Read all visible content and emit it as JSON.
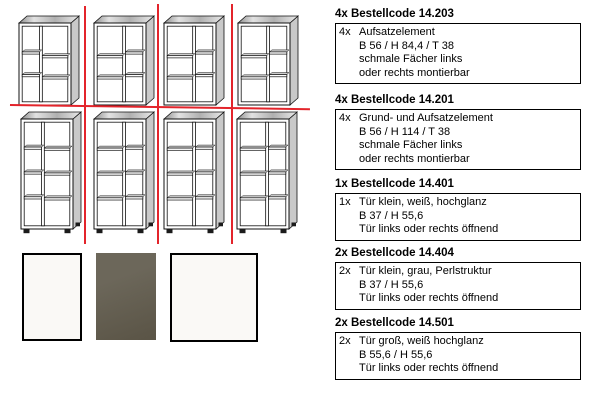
{
  "page": {
    "background": "#ffffff",
    "guide_color": "#e3242b"
  },
  "drawings": {
    "description": "shelf-unit-line-drawings",
    "units": [
      {
        "name": "shelf-aufsatz-1",
        "row": "top",
        "narrow": "left"
      },
      {
        "name": "shelf-aufsatz-2",
        "row": "top",
        "narrow": "right"
      },
      {
        "name": "shelf-aufsatz-3",
        "row": "top",
        "narrow": "right"
      },
      {
        "name": "shelf-aufsatz-4",
        "row": "top",
        "narrow": "right"
      },
      {
        "name": "shelf-grund-1",
        "row": "bottom",
        "narrow": "left"
      },
      {
        "name": "shelf-grund-2",
        "row": "bottom",
        "narrow": "right"
      },
      {
        "name": "shelf-grund-3",
        "row": "bottom",
        "narrow": "right"
      },
      {
        "name": "shelf-grund-4",
        "row": "bottom",
        "narrow": "right"
      }
    ]
  },
  "swatches": [
    {
      "name": "swatch-white-gloss-small",
      "color": "#faf9f6",
      "border": true
    },
    {
      "name": "swatch-grey-pearl",
      "color": "#6c675a",
      "color2": "#5b5547",
      "border": false
    },
    {
      "name": "swatch-white-gloss-large",
      "color": "#faf9f6",
      "border": true
    }
  ],
  "sections": [
    {
      "heading": "4x Bestellcode 14.203",
      "qty": "4x",
      "lines": [
        "Aufsatzelement",
        "B 56 / H 84,4 / T 38",
        "schmale Fächer links",
        "oder rechts montierbar"
      ]
    },
    {
      "heading": "4x Bestellcode 14.201",
      "qty": "4x",
      "lines": [
        "Grund- und Aufsatzelement",
        "B 56 / H 114 / T 38",
        "schmale Fächer links",
        "oder rechts montierbar"
      ]
    },
    {
      "heading": "1x Bestellcode 14.401",
      "qty": "1x",
      "lines": [
        "Tür klein, weiß, hochglanz",
        "B 37 / H 55,6",
        "Tür links oder rechts öffnend"
      ]
    },
    {
      "heading": "2x Bestellcode 14.404",
      "qty": "2x",
      "lines": [
        "Tür klein, grau, Perlstruktur",
        "B 37 / H 55,6",
        "Tür links oder rechts öffnend"
      ]
    },
    {
      "heading": "2x Bestellcode 14.501",
      "qty": "2x",
      "lines": [
        "Tür groß, weiß hochglanz",
        "B 55,6 / H 55,6",
        "Tür links oder rechts öffnend"
      ]
    }
  ]
}
